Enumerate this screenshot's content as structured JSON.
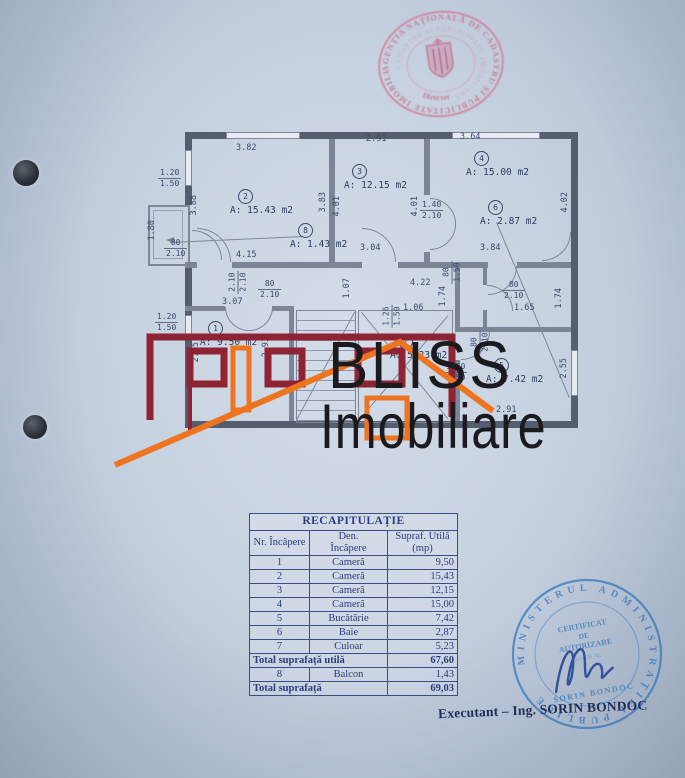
{
  "top_stamp": {
    "ring_text": "AGENȚIA NAȚIONALĂ DE CADASTRU ȘI PUBLICITATE IMOBILIARĂ ★",
    "inner_ring_text": "CADASTRU ȘI PUBLICITATE IMOBILIARĂ",
    "center_label": "Director",
    "color": "#d2809c"
  },
  "floor_plan": {
    "rooms": [
      {
        "num": "2",
        "area": "A: 15.43 m2"
      },
      {
        "num": "3",
        "area": "A: 12.15 m2"
      },
      {
        "num": "4",
        "area": "A: 15.00 m2"
      },
      {
        "num": "6",
        "area": "A: 2.87 m2"
      },
      {
        "num": "8",
        "area": "A: 1.43 m2"
      },
      {
        "num": "1",
        "area": "A: 9.50 m2"
      },
      {
        "num": "7",
        "area": "A: 5.23 m2"
      },
      {
        "num": "5",
        "area": "A: 7.42 m2"
      }
    ],
    "dims": [
      "3.82",
      "2.91",
      "3.64",
      "4.15",
      "3.04",
      "3.84",
      "3.07",
      "4.22",
      "1.06",
      "1.65",
      "2.91",
      "3.88",
      "3.83",
      "4.01",
      "4.01",
      "4.02",
      "1.80",
      "1.74",
      "1.74",
      "2.85",
      "2.93",
      "2.55",
      "1.07"
    ],
    "door_marks": [
      {
        "a": "1.20",
        "b": "1.50"
      },
      {
        "a": "80",
        "b": "2.10"
      },
      {
        "a": "1.40",
        "b": "2.10"
      },
      {
        "a": "2.10",
        "b": "2.10"
      },
      {
        "a": "80",
        "b": "2.10"
      },
      {
        "a": "80",
        "b": "1.50"
      },
      {
        "a": "80",
        "b": "2.10"
      },
      {
        "a": "1.26",
        "b": "1.50"
      },
      {
        "a": "1.50",
        "b": "1.50"
      },
      {
        "a": "80",
        "b": "2.10"
      },
      {
        "a": "1.20",
        "b": "1.50"
      }
    ]
  },
  "logo": {
    "line1": "BLISS",
    "line2": "Imobiliare",
    "building_color": "#8e2333",
    "roof_color": "#ee7420"
  },
  "table": {
    "title": "RECAPITULAȚIE",
    "headers": {
      "col1": "Nr. Încăpere",
      "col2a": "Den.",
      "col2b": "Încăpere",
      "col3a": "Supraf. Utilă",
      "col3b": "(mp)"
    },
    "rows": [
      {
        "nr": "1",
        "den": "Cameră",
        "mp": "9,50"
      },
      {
        "nr": "2",
        "den": "Cameră",
        "mp": "15,43"
      },
      {
        "nr": "3",
        "den": "Cameră",
        "mp": "12,15"
      },
      {
        "nr": "4",
        "den": "Cameră",
        "mp": "15,00"
      },
      {
        "nr": "5",
        "den": "Bucătărie",
        "mp": "7,42"
      },
      {
        "nr": "6",
        "den": "Baie",
        "mp": "2,87"
      },
      {
        "nr": "7",
        "den": "Culoar",
        "mp": "5,23"
      }
    ],
    "total_utila": {
      "label": "Total suprafață utilă",
      "value": "67,60"
    },
    "balcon_row": {
      "nr": "8",
      "den": "Balcon",
      "mp": "1,43"
    },
    "total": {
      "label": "Total suprafață",
      "value": "69,03"
    }
  },
  "bottom_stamp": {
    "ring_text": "MINISTERUL ADMINISTRAȚIEI PUBLICE",
    "line1": "CERTIFICAT",
    "line2": "DE",
    "line3": "AUTORIZARE",
    "line4": "Seria B Nr.",
    "line5": "SORIN BONDOC",
    "color": "#4b87c4"
  },
  "footer": {
    "executant": "Executant – Ing. SORIN BONDOC"
  }
}
